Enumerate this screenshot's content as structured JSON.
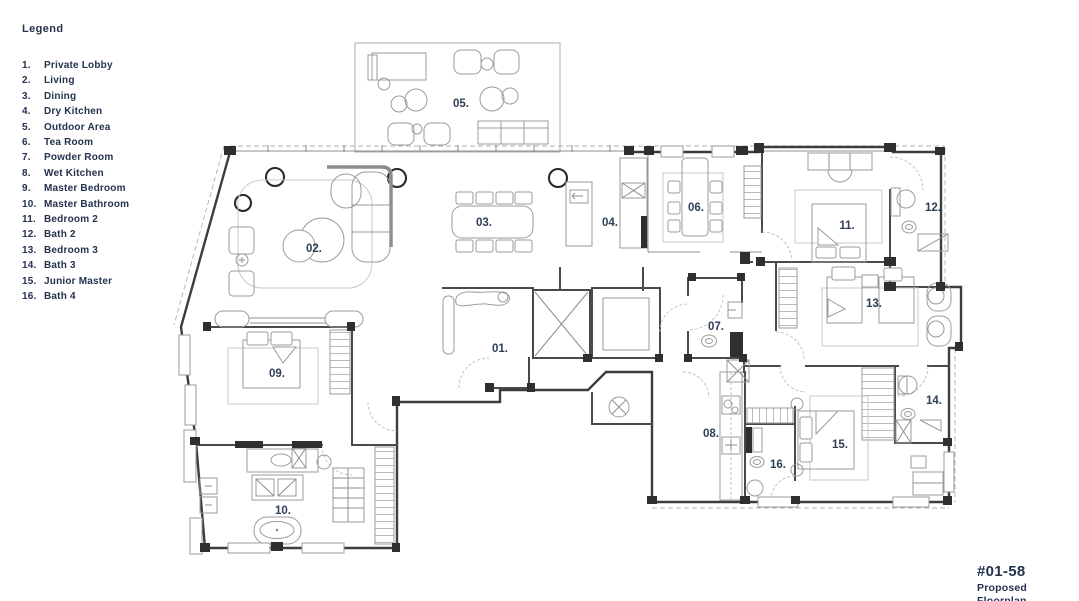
{
  "legend": {
    "title": "Legend",
    "items": [
      {
        "num": "1.",
        "label": "Private Lobby"
      },
      {
        "num": "2.",
        "label": "Living"
      },
      {
        "num": "3.",
        "label": "Dining"
      },
      {
        "num": "4.",
        "label": "Dry Kitchen"
      },
      {
        "num": "5.",
        "label": "Outdoor Area"
      },
      {
        "num": "6.",
        "label": "Tea Room"
      },
      {
        "num": "7.",
        "label": "Powder Room"
      },
      {
        "num": "8.",
        "label": "Wet Kitchen"
      },
      {
        "num": "9.",
        "label": "Master Bedroom"
      },
      {
        "num": "10.",
        "label": "Master Bathroom"
      },
      {
        "num": "11.",
        "label": "Bedroom 2"
      },
      {
        "num": "12.",
        "label": "Bath 2"
      },
      {
        "num": "13.",
        "label": "Bedroom 3"
      },
      {
        "num": "14.",
        "label": "Bath 3"
      },
      {
        "num": "15.",
        "label": "Junior Master"
      },
      {
        "num": "16.",
        "label": "Bath 4"
      }
    ]
  },
  "plan": {
    "rooms": [
      {
        "id": "01",
        "label": "01.",
        "name": "private-lobby",
        "x": 500,
        "y": 352
      },
      {
        "id": "02",
        "label": "02.",
        "name": "living",
        "x": 314,
        "y": 252
      },
      {
        "id": "03",
        "label": "03.",
        "name": "dining",
        "x": 484,
        "y": 226
      },
      {
        "id": "04",
        "label": "04.",
        "name": "dry-kitchen",
        "x": 610,
        "y": 226
      },
      {
        "id": "05",
        "label": "05.",
        "name": "outdoor-area",
        "x": 461,
        "y": 107
      },
      {
        "id": "06",
        "label": "06.",
        "name": "tea-room",
        "x": 696,
        "y": 211
      },
      {
        "id": "07",
        "label": "07.",
        "name": "powder-room",
        "x": 716,
        "y": 330
      },
      {
        "id": "08",
        "label": "08.",
        "name": "wet-kitchen",
        "x": 711,
        "y": 437
      },
      {
        "id": "09",
        "label": "09.",
        "name": "master-bedroom",
        "x": 277,
        "y": 377
      },
      {
        "id": "10",
        "label": "10.",
        "name": "master-bathroom",
        "x": 283,
        "y": 514
      },
      {
        "id": "11",
        "label": "11.",
        "name": "bedroom-2",
        "x": 847,
        "y": 229
      },
      {
        "id": "12",
        "label": "12.",
        "name": "bath-2",
        "x": 933,
        "y": 211
      },
      {
        "id": "13",
        "label": "13.",
        "name": "bedroom-3",
        "x": 874,
        "y": 307
      },
      {
        "id": "14",
        "label": "14.",
        "name": "bath-3",
        "x": 934,
        "y": 404
      },
      {
        "id": "15",
        "label": "15.",
        "name": "junior-master",
        "x": 840,
        "y": 448
      },
      {
        "id": "16",
        "label": "16.",
        "name": "bath-4",
        "x": 778,
        "y": 468
      }
    ]
  },
  "title_block": {
    "unit": "#01-58",
    "subtitle": "Proposed Floorplan"
  },
  "colors": {
    "accent": "#24324e",
    "wall": "#3d3d3d",
    "furniture": "#9b9b9b",
    "light_line": "#c9c9c9"
  }
}
